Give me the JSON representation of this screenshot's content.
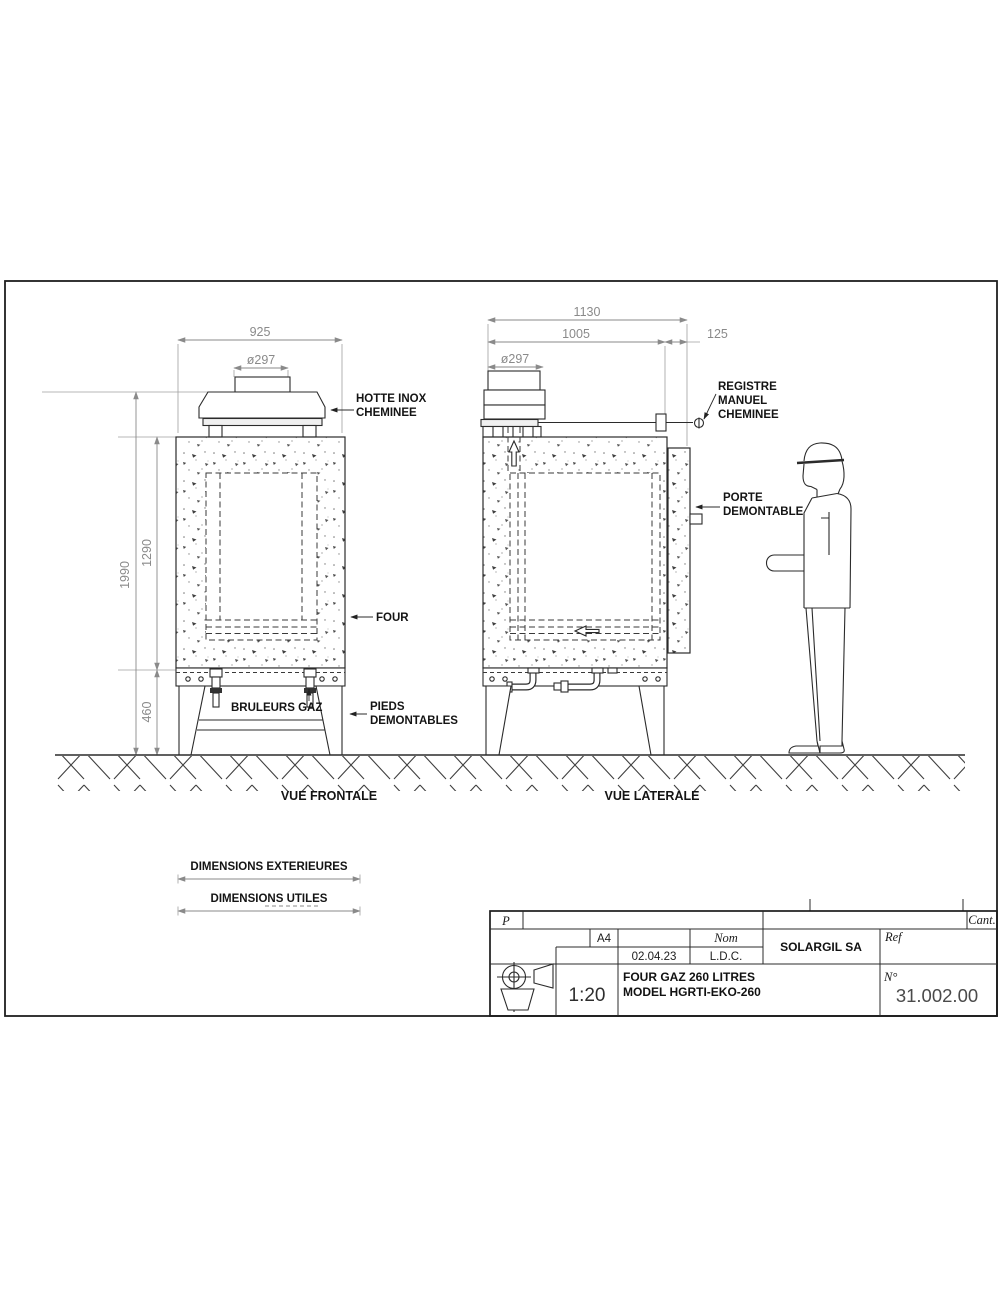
{
  "colors": {
    "line": "#2b2b2b",
    "dim_text": "#8a8a8a",
    "label_text": "#141414"
  },
  "front_view": {
    "caption": "VUE FRONTALE",
    "dims": {
      "width": "925",
      "chimney_diameter": "ø297",
      "total_height": "1990",
      "body_height": "1290",
      "legs_height": "460",
      "chamber_height": "830",
      "chamber_width": "450"
    },
    "labels": {
      "hood_line1": "HOTTE INOX",
      "hood_line2": "CHEMINEE",
      "kiln": "FOUR",
      "burners": "BRULEURS GAZ",
      "feet_line1": "PIEDS",
      "feet_line2": "DEMONTABLES"
    }
  },
  "side_view": {
    "caption": "VUE LATERALE",
    "dims": {
      "total_depth": "1130",
      "body_depth": "1005",
      "door_depth": "125",
      "chimney_diameter": "ø297",
      "chamber_depth": "690"
    },
    "labels": {
      "damper_line1": "REGISTRE",
      "damper_line2": "MANUEL",
      "damper_line3": "CHEMINEE",
      "door_line1": "PORTE",
      "door_line2": "DEMONTABLE"
    }
  },
  "legend": {
    "exterior": "DIMENSIONS EXTERIEURES",
    "useful": "DIMENSIONS UTILES"
  },
  "title_block": {
    "p": "P",
    "cant": "Cant.",
    "format": "A4",
    "nom": "Nom",
    "company": "SOLARGIL SA",
    "ref": "Ref",
    "date": "02.04.23",
    "initials": "L.D.C.",
    "title_line1": "FOUR GAZ 260 LITRES",
    "title_line2": "MODEL HGRTI-EKO-260",
    "scale": "1:20",
    "number_label": "N°",
    "drawing_number": "31.002.00"
  }
}
